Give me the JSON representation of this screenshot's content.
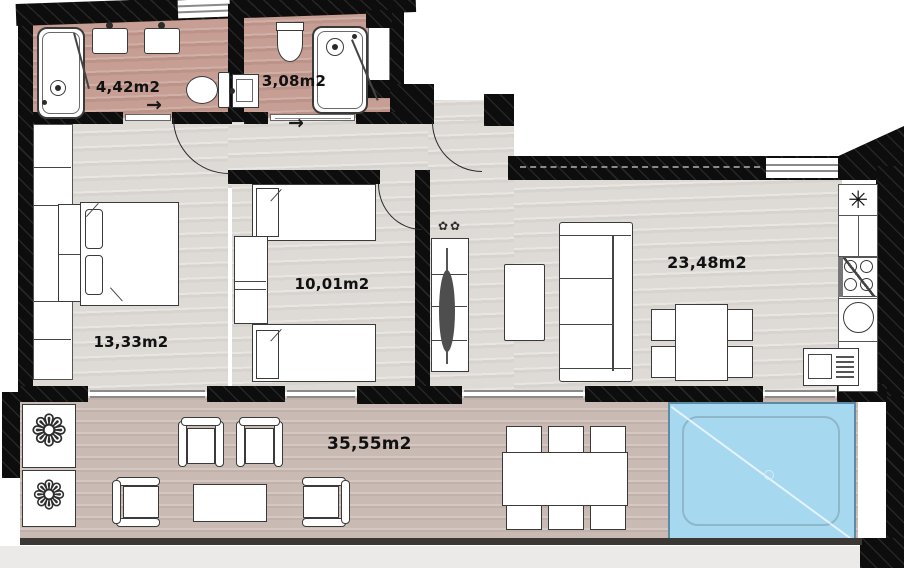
{
  "plan": {
    "rooms": [
      {
        "id": "bathroom-ensuite",
        "area": "4,42m2"
      },
      {
        "id": "bathroom",
        "area": "3,08m2"
      },
      {
        "id": "bedroom-twin",
        "area": "10,01m2"
      },
      {
        "id": "bedroom-double",
        "area": "13,33m2"
      },
      {
        "id": "living-kitchen",
        "area": "23,48m2"
      },
      {
        "id": "terrace",
        "area": "35,55m2"
      }
    ],
    "symbols": {
      "entry_arrow": "→",
      "kitchen_star": "✳",
      "planter_flower": "❁",
      "tv_plant": "✿✿"
    },
    "colors": {
      "wall": "#0d0d0d",
      "bath_floor": "#c69e94",
      "interior_floor": "#dedad6",
      "terrace_floor": "#c9bab3",
      "pool_water": "#a6d8f0",
      "furniture_outline": "#3a3a3a"
    }
  }
}
